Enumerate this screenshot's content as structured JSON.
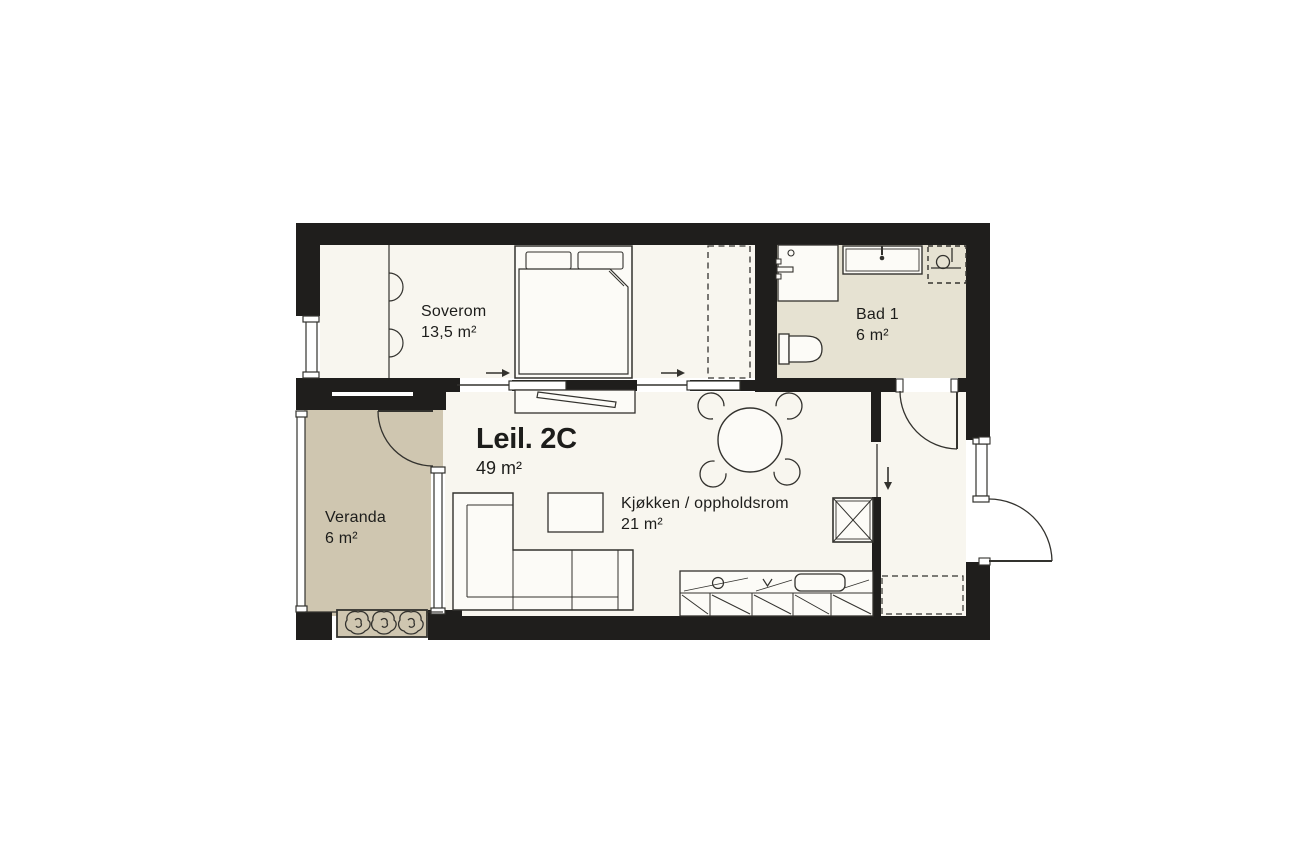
{
  "apartment": {
    "name": "Leil. 2C",
    "area": "49 m²"
  },
  "rooms": {
    "bedroom": {
      "label": "Soverom",
      "area": "13,5 m²"
    },
    "bathroom": {
      "label": "Bad 1",
      "area": "6 m²"
    },
    "kitchen_living": {
      "label": "Kjøkken / oppholdsrom",
      "area": "21 m²"
    },
    "veranda": {
      "label": "Veranda",
      "area": "6 m²"
    }
  },
  "symbols": {
    "bed-icon": "double bed with two pillows and folded duvet",
    "wardrobe-doors-icon": "two semicircle door swings on wardrobe wall",
    "dashed-wardrobe-icon": "dashed rectangle wardrobe outline",
    "tv-bench-icon": "bench with angled TV bar",
    "sofa-icon": "L-shaped corner sofa outline",
    "coffee-table-icon": "rectangle table",
    "dining-table-icon": "round table with four chair arcs",
    "kitchen-counter-icon": "counter with cabinet diagonals, sink and hob",
    "tall-cabinet-icon": "square with X (fridge/tall unit)",
    "vanity-icon": "washbasin counter with wall tap",
    "bathtub-icon": "double-outline tub with tap",
    "shower-icon": "dashed square with floor drain",
    "toilet-icon": "cistern and rounded bowl",
    "planter-icon": "box with three plant blobs",
    "sliding-door-arrow-icon": "→ slide direction",
    "entry-arrow-icon": "↓ entry direction",
    "door-swing-icon": "quarter-circle arc",
    "window-icon": "thin double-line glazing"
  },
  "colors": {
    "wall": "#1f1e1c",
    "floor": "#f8f6ef",
    "bath_floor": "#e6e2d2",
    "veranda_floor": "#cfc6b0",
    "line": "#33322e",
    "furniture_fill": "#fcfbf7",
    "text": "#1d1d1b",
    "background": "#ffffff"
  }
}
